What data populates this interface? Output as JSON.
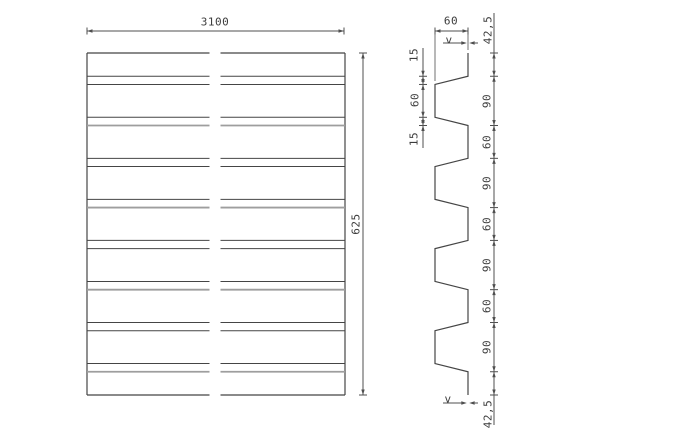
{
  "drawing": {
    "background_color": "#ffffff",
    "line_color": "#454545",
    "secondary_line_color": "#9e9e9e",
    "dim_color": "#4f4f4f",
    "text_color": "#3c3c3c",
    "plan_view": {
      "length_dim_label": "3100",
      "width_dim_label": "625"
    },
    "profile_view": {
      "total_width_mm": 625,
      "rib_depth_mm": 60,
      "segments_mm": [
        42.5,
        15,
        60,
        15,
        60,
        15,
        60,
        15,
        60,
        15,
        60,
        15,
        60,
        15,
        60,
        15,
        42.5
      ],
      "depth_dim_label": "60",
      "thickness_dim_label_top": "v",
      "thickness_dim_label_bottom": "v",
      "left_dim_labels": [
        "15",
        "60",
        "15"
      ],
      "right_dim_labels": [
        "42,5",
        "90",
        "60",
        "90",
        "60",
        "90",
        "60",
        "90",
        "42,5"
      ]
    }
  }
}
